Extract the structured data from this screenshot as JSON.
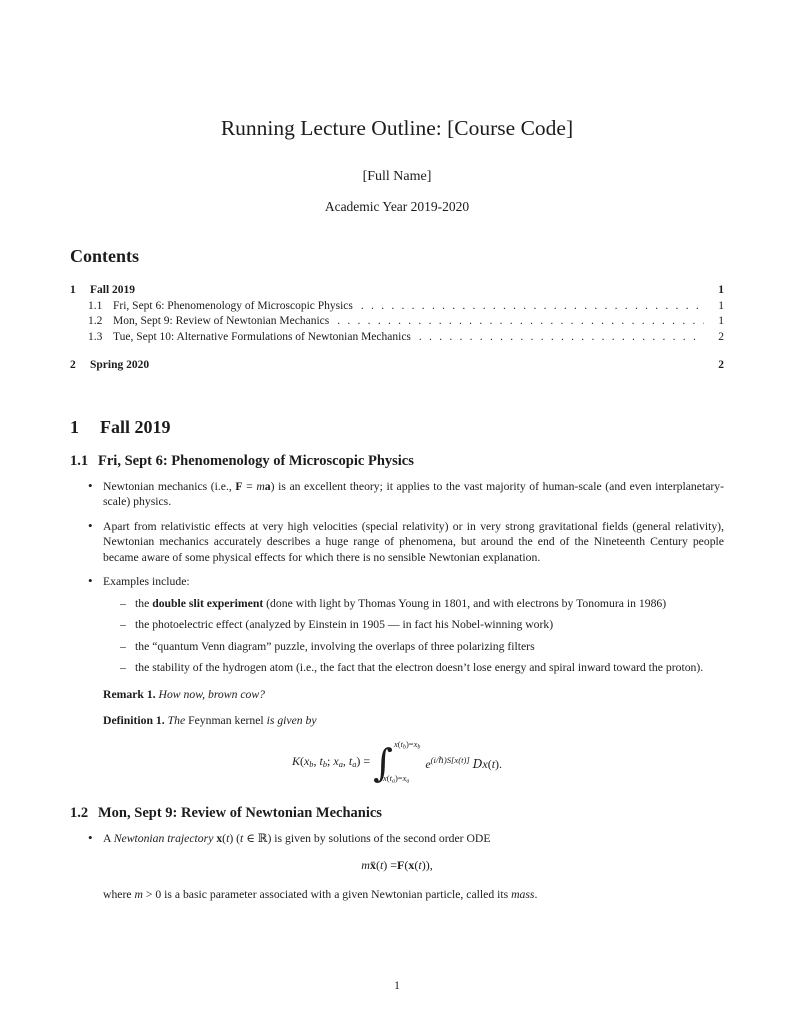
{
  "header": {
    "title": "Running Lecture Outline: [Course Code]",
    "author": "[Full Name]",
    "academic_year": "Academic Year 2019-2020"
  },
  "contents": {
    "heading": "Contents",
    "entries": [
      {
        "num": "1",
        "label": "Fall 2019",
        "page": "1"
      },
      {
        "num": "1.1",
        "label": "Fri, Sept 6: Phenomenology of Microscopic Physics",
        "page": "1"
      },
      {
        "num": "1.2",
        "label": "Mon, Sept 9: Review of Newtonian Mechanics",
        "page": "1"
      },
      {
        "num": "1.3",
        "label": "Tue, Sept 10: Alternative Formulations of Newtonian Mechanics",
        "page": "2"
      },
      {
        "num": "2",
        "label": "Spring 2020",
        "page": "2"
      }
    ]
  },
  "sections": {
    "fall": {
      "num": "1",
      "title": "Fall 2019"
    },
    "s11": {
      "num": "1.1",
      "title": "Fri, Sept 6: Phenomenology of Microscopic Physics"
    },
    "s12": {
      "num": "1.2",
      "title": "Mon, Sept 9: Review of Newtonian Mechanics"
    }
  },
  "s11": {
    "bullet1": [
      {
        "t": "Newtonian mechanics (i.e., "
      },
      {
        "t": "F",
        "s": "mb"
      },
      {
        "t": " = "
      },
      {
        "t": "m",
        "s": "mi"
      },
      {
        "t": "a",
        "s": "mb"
      },
      {
        "t": ") is an excellent theory; it applies to the vast majority of human-scale (and even interplanetary-scale) physics."
      }
    ],
    "bullet2": [
      {
        "t": "Apart from relativistic effects at very high velocities (special relativity) or in very strong gravitational fields (general relativity), Newtonian mechanics accurately describes a huge range of phenomena, but around the end of the Nineteenth Century people became aware of some physical effects for which there is no sensible Newtonian explanation."
      }
    ],
    "bullet3": [
      {
        "t": "Examples include:"
      }
    ],
    "examples": [
      [
        {
          "t": "the "
        },
        {
          "t": "double slit experiment",
          "s": "b"
        },
        {
          "t": " (done with light by Thomas Young in 1801, and with electrons by Tonomura in 1986)"
        }
      ],
      [
        {
          "t": "the photoelectric effect (analyzed by Einstein in 1905 — in fact his Nobel-winning work)"
        }
      ],
      [
        {
          "t": "the “quantum Venn diagram” puzzle, involving the overlaps of three polarizing filters"
        }
      ],
      [
        {
          "t": "the stability of the hydrogen atom (i.e., the fact that the electron doesn’t lose energy and spiral inward toward the proton)."
        }
      ]
    ],
    "remark": {
      "label": "Remark 1.",
      "body": [
        {
          "t": "How now, brown cow?",
          "s": "i"
        }
      ]
    },
    "definition": {
      "label": "Definition 1.",
      "body": [
        {
          "t": "The ",
          "s": "i"
        },
        {
          "t": "Feynman kernel"
        },
        {
          "t": " is given by",
          "s": "i"
        }
      ]
    },
    "kernel": {
      "lhs": [
        {
          "t": "K",
          "s": "mi"
        },
        {
          "t": "("
        },
        {
          "t": "x",
          "s": "mi"
        },
        {
          "t": "b",
          "s": "sub"
        },
        {
          "t": ", "
        },
        {
          "t": "t",
          "s": "mi"
        },
        {
          "t": "b",
          "s": "sub"
        },
        {
          "t": "; "
        },
        {
          "t": "x",
          "s": "mi"
        },
        {
          "t": "a",
          "s": "sub"
        },
        {
          "t": ", "
        },
        {
          "t": "t",
          "s": "mi"
        },
        {
          "t": "a",
          "s": "sub"
        },
        {
          "t": ") = "
        }
      ],
      "integral_sign": "∫",
      "upper": [
        {
          "t": "x",
          "s": "mi"
        },
        {
          "t": "("
        },
        {
          "t": "t",
          "s": "mi"
        },
        {
          "t": "b",
          "s": "sub"
        },
        {
          "t": ")="
        },
        {
          "t": "x",
          "s": "mi"
        },
        {
          "t": "b",
          "s": "sub"
        }
      ],
      "lower": [
        {
          "t": "x",
          "s": "mi"
        },
        {
          "t": "("
        },
        {
          "t": "t",
          "s": "mi"
        },
        {
          "t": "a",
          "s": "sub"
        },
        {
          "t": ")="
        },
        {
          "t": "x",
          "s": "mi"
        },
        {
          "t": "a",
          "s": "sub"
        }
      ],
      "rhs": [
        {
          "t": "e",
          "s": "mi"
        },
        {
          "t": "(i/ℏ)S[x(t)]",
          "s": "sup"
        },
        {
          "t": " "
        },
        {
          "t": "D",
          "s": "scr"
        },
        {
          "t": "x",
          "s": "mi"
        },
        {
          "t": "("
        },
        {
          "t": "t",
          "s": "mi"
        },
        {
          "t": ")."
        }
      ]
    }
  },
  "s12": {
    "bullet1": [
      {
        "t": "A "
      },
      {
        "t": "Newtonian trajectory",
        "s": "i"
      },
      {
        "t": " "
      },
      {
        "t": "x",
        "s": "mb"
      },
      {
        "t": "("
      },
      {
        "t": "t",
        "s": "mi"
      },
      {
        "t": ") ("
      },
      {
        "t": "t",
        "s": "mi"
      },
      {
        "t": " ∈ ℝ) is given by solutions of the second order ODE"
      }
    ],
    "ode": [
      {
        "t": "m",
        "s": "mi"
      },
      {
        "t": " "
      },
      {
        "t": "ẍ",
        "s": "mb"
      },
      {
        "t": "("
      },
      {
        "t": "t",
        "s": "mi"
      },
      {
        "t": ") = "
      },
      {
        "t": "F",
        "s": "mb"
      },
      {
        "t": "("
      },
      {
        "t": "x",
        "s": "mb"
      },
      {
        "t": "("
      },
      {
        "t": "t",
        "s": "mi"
      },
      {
        "t": ")),"
      }
    ],
    "after": [
      {
        "t": "where "
      },
      {
        "t": "m",
        "s": "mi"
      },
      {
        "t": " > 0 is a basic parameter associated with a given Newtonian particle, called its "
      },
      {
        "t": "mass",
        "s": "i"
      },
      {
        "t": "."
      }
    ]
  },
  "footer": {
    "page_number": "1"
  }
}
